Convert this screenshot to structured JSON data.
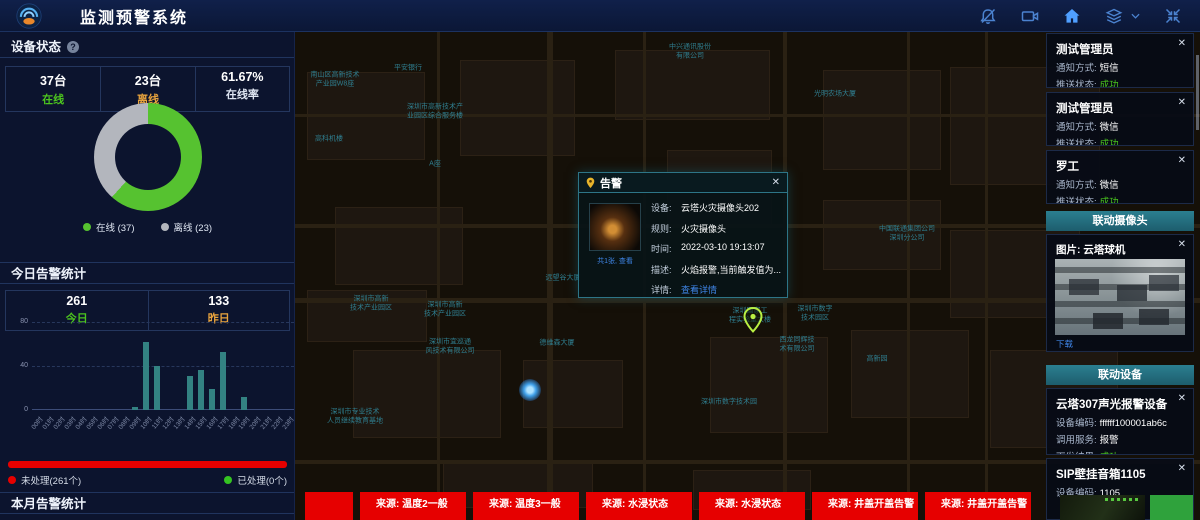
{
  "header": {
    "title": "监测预警系统",
    "icons": [
      {
        "name": "bell-muted-icon"
      },
      {
        "name": "video-camera-icon"
      },
      {
        "name": "home-icon"
      },
      {
        "name": "layers-icon"
      },
      {
        "name": "collapse-icon"
      }
    ]
  },
  "ui": {
    "close_glyph": "✕",
    "help_glyph": "?"
  },
  "device_status": {
    "title": "设备状态",
    "stats": [
      {
        "value": "37台",
        "label": "在线",
        "label_color": "#4cc41e"
      },
      {
        "value": "23台",
        "label": "离线",
        "label_color": "#e8a33d"
      },
      {
        "value": "61.67%",
        "label": "在线率",
        "label_color": "#dfe6f2"
      }
    ]
  },
  "today_alerts": {
    "title": "今日告警统计",
    "stats": [
      {
        "value": "261",
        "label": "今日",
        "label_color": "#4cc41e"
      },
      {
        "value": "133",
        "label": "昨日",
        "label_color": "#e8a33d"
      }
    ],
    "progress": {
      "unhandled": "未处理(261个)",
      "handled": "已处理(0个)",
      "unhandled_color": "#e60000",
      "handled_color": "#35c422",
      "unhandled_ratio": 1
    }
  },
  "month_alerts": {
    "title": "本月告警统计",
    "values": [
      "763",
      "1146"
    ]
  },
  "chart_data": [
    {
      "type": "pie",
      "donut": true,
      "title": "设备状态",
      "labels": [
        "在线",
        "离线"
      ],
      "values": [
        37,
        23
      ],
      "colors": [
        "#56c230",
        "#b3b6bd"
      ],
      "legend": [
        "在线 (37)",
        "离线 (23)"
      ],
      "legend_position": "bottom"
    },
    {
      "type": "bar",
      "title": "今日告警统计",
      "categories": [
        "00时",
        "01时",
        "02时",
        "03时",
        "04时",
        "05时",
        "06时",
        "07时",
        "08时",
        "09时",
        "10时",
        "11时",
        "12时",
        "13时",
        "14时",
        "15时",
        "16时",
        "17时",
        "18时",
        "19时",
        "20时",
        "21时",
        "22时",
        "23时"
      ],
      "values": [
        0,
        0,
        0,
        0,
        0,
        0,
        0,
        0,
        0,
        3,
        62,
        40,
        0,
        0,
        31,
        36,
        19,
        53,
        0,
        12,
        0,
        0,
        0,
        0
      ],
      "xlabel": "",
      "ylabel": "",
      "ylim": [
        0,
        80
      ],
      "yticks": [
        0,
        40,
        80
      ],
      "grid": true,
      "bar_color": "#338282"
    }
  ],
  "map_popup": {
    "title": "告警",
    "thumb_caption": "共1张, 查看",
    "rows": [
      {
        "label": "设备:",
        "value": "云塔火灾摄像头202"
      },
      {
        "label": "规则:",
        "value": "火灾摄像头"
      },
      {
        "label": "时间:",
        "value": "2022-03-10 19:13:07"
      },
      {
        "label": "描述:",
        "value": "火焰报警,当前触发值为..."
      },
      {
        "label": "详情:",
        "value": "查看详情",
        "link": true
      }
    ]
  },
  "map": {
    "labels": [
      {
        "text": "中兴通讯股份\n有限公司",
        "x": 395,
        "y": 20
      },
      {
        "text": "平安银行",
        "x": 113,
        "y": 36
      },
      {
        "text": "南山区高新技术\n产业园W8座",
        "x": 40,
        "y": 48
      },
      {
        "text": "深圳市高新技术产\n业园区综合服务楼",
        "x": 140,
        "y": 80
      },
      {
        "text": "高科机楼",
        "x": 34,
        "y": 107
      },
      {
        "text": "A座",
        "x": 140,
        "y": 132
      },
      {
        "text": "光明农场大厦",
        "x": 540,
        "y": 62
      },
      {
        "text": "中兴工业园",
        "x": 307,
        "y": 154
      },
      {
        "text": "远望谷大厦",
        "x": 268,
        "y": 246
      },
      {
        "text": "德维森大厦",
        "x": 262,
        "y": 311
      },
      {
        "text": "深圳市高新\n技术产业园区",
        "x": 76,
        "y": 272
      },
      {
        "text": "深圳市高新\n技术产业园区",
        "x": 150,
        "y": 278
      },
      {
        "text": "深圳市宜巡通\n风技术有限公司",
        "x": 155,
        "y": 315
      },
      {
        "text": "深圳市专业技术\n人员继续教育基地",
        "x": 60,
        "y": 385
      },
      {
        "text": "深圳国家工\n程实验室大楼",
        "x": 455,
        "y": 284
      },
      {
        "text": "深圳市数字\n技术园区",
        "x": 520,
        "y": 282
      },
      {
        "text": "西龙同辉技\n术有限公司",
        "x": 502,
        "y": 313
      },
      {
        "text": "深圳市数字技术园",
        "x": 434,
        "y": 370
      },
      {
        "text": "中国联通集团公司\n深圳分公司",
        "x": 612,
        "y": 202
      },
      {
        "text": "高新园",
        "x": 582,
        "y": 327
      }
    ],
    "pin": {
      "x": 458,
      "y": 301
    },
    "alert_dot": {
      "x": 235,
      "y": 358
    }
  },
  "notifications": [
    {
      "name": "测试管理员",
      "rows": [
        {
          "label": "通知方式:",
          "value": "短信"
        },
        {
          "label": "推送状态:",
          "value": "成功",
          "ok": true
        }
      ]
    },
    {
      "name": "测试管理员",
      "rows": [
        {
          "label": "通知方式:",
          "value": "微信"
        },
        {
          "label": "推送状态:",
          "value": "成功",
          "ok": true
        }
      ]
    },
    {
      "name": "罗工",
      "rows": [
        {
          "label": "通知方式:",
          "value": "微信"
        },
        {
          "label": "推送状态:",
          "value": "成功",
          "ok": true
        }
      ]
    }
  ],
  "camera_panel": {
    "header": "联动摄像头",
    "image_title": "图片: 云塔球机",
    "download_label": "下载"
  },
  "device_panel": {
    "header": "联动设备",
    "devices": [
      {
        "name": "云塔307声光报警设备",
        "rows": [
          {
            "label": "设备编码:",
            "value": "ffffff100001ab6c"
          },
          {
            "label": "调用服务:",
            "value": "报警"
          },
          {
            "label": "下发结果:",
            "value": "成功",
            "ok": true
          }
        ]
      },
      {
        "name": "SIP壁挂音箱1105",
        "rows": [
          {
            "label": "设备编码:",
            "value": "1105"
          }
        ]
      }
    ]
  },
  "bottom_alerts": [
    {
      "label": ""
    },
    {
      "label": "来源: 温度2一般"
    },
    {
      "label": "来源: 温度3一般"
    },
    {
      "label": "来源: 水浸状态"
    },
    {
      "label": "来源: 水浸状态"
    },
    {
      "label": "来源: 井盖开盖告警"
    },
    {
      "label": "来源: 井盖开盖告警"
    }
  ]
}
